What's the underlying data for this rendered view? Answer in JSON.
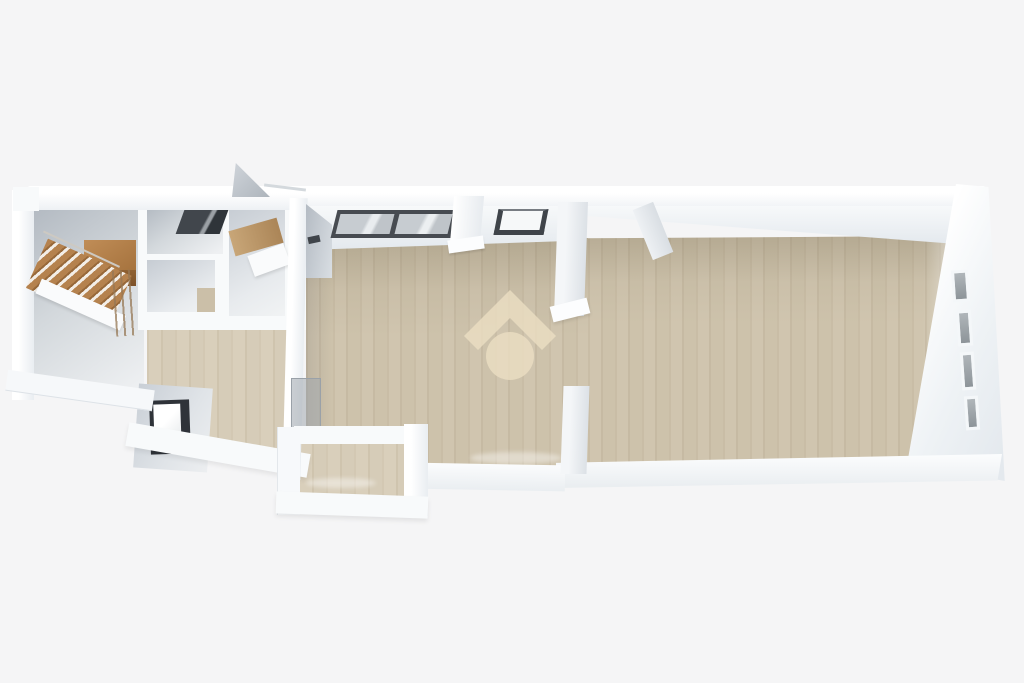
{
  "image": {
    "kind": "3D top-down floor plan rendering (real-estate listing style)",
    "width": 1024,
    "height": 683,
    "background_color": "#f5f5f6",
    "visible_text": "none"
  },
  "watermark": {
    "icon": "house-chevron-over-circle",
    "description": "semi-transparent cream house logo (roof chevron above a circle) centered on the main room floor",
    "color": "#ecdfc3",
    "opacity": 0.8
  },
  "palette": {
    "wall_white": "#fafbfc",
    "wall_shadow": "#dfe4e9",
    "floor_wood": "#cec3ad",
    "floor_wood_dark": "#c5b9a2",
    "floor_gray": "#cdd2d7",
    "stair_wood": "#b5814d",
    "window_frame_dark": "#3f444a",
    "window_glass": "#c2c7cc",
    "side_window_glass": "#9aa1a6"
  },
  "rooms": [
    {
      "id": "stairwell",
      "position": "far left",
      "floor": "gray",
      "feature": "wooden staircase with upper landing and handrail"
    },
    {
      "id": "small-room-top",
      "position": "left column top",
      "floor": "gray",
      "feature": "dark ceiling/top-wall window"
    },
    {
      "id": "small-room-middle",
      "position": "left column middle",
      "floor": "gray"
    },
    {
      "id": "small-room-right",
      "position": "left column right",
      "floor": "gray",
      "feature": "tan wall band and white ledge"
    },
    {
      "id": "lower-left-room",
      "position": "lower left",
      "floor": "wood",
      "feature": "black-framed window on outer wall"
    },
    {
      "id": "central-room",
      "position": "center",
      "floor": "wood",
      "features": [
        "large dark-framed double window on top wall",
        "small dark-framed window on top wall",
        "white pillar stub",
        "glass door leaning at doorway",
        "wide opening to right room"
      ]
    },
    {
      "id": "right-great-room",
      "position": "right half",
      "floor": "wood",
      "feature": "four small gray windows along right wall"
    },
    {
      "id": "alcove",
      "position": "bottom protrusion below central room",
      "floor": "wood"
    }
  ],
  "windows": {
    "top_wall_large_double": 1,
    "top_wall_small": 1,
    "right_wall_small_gray": 4,
    "lower_left_dark_framed": 1,
    "left_column_ceiling_dark": 1
  },
  "doors": {
    "open_leaf_above_top_wall": 1,
    "open_leaf_at_right_room_top": 1,
    "glass_leaf_central_doorway": 1
  }
}
